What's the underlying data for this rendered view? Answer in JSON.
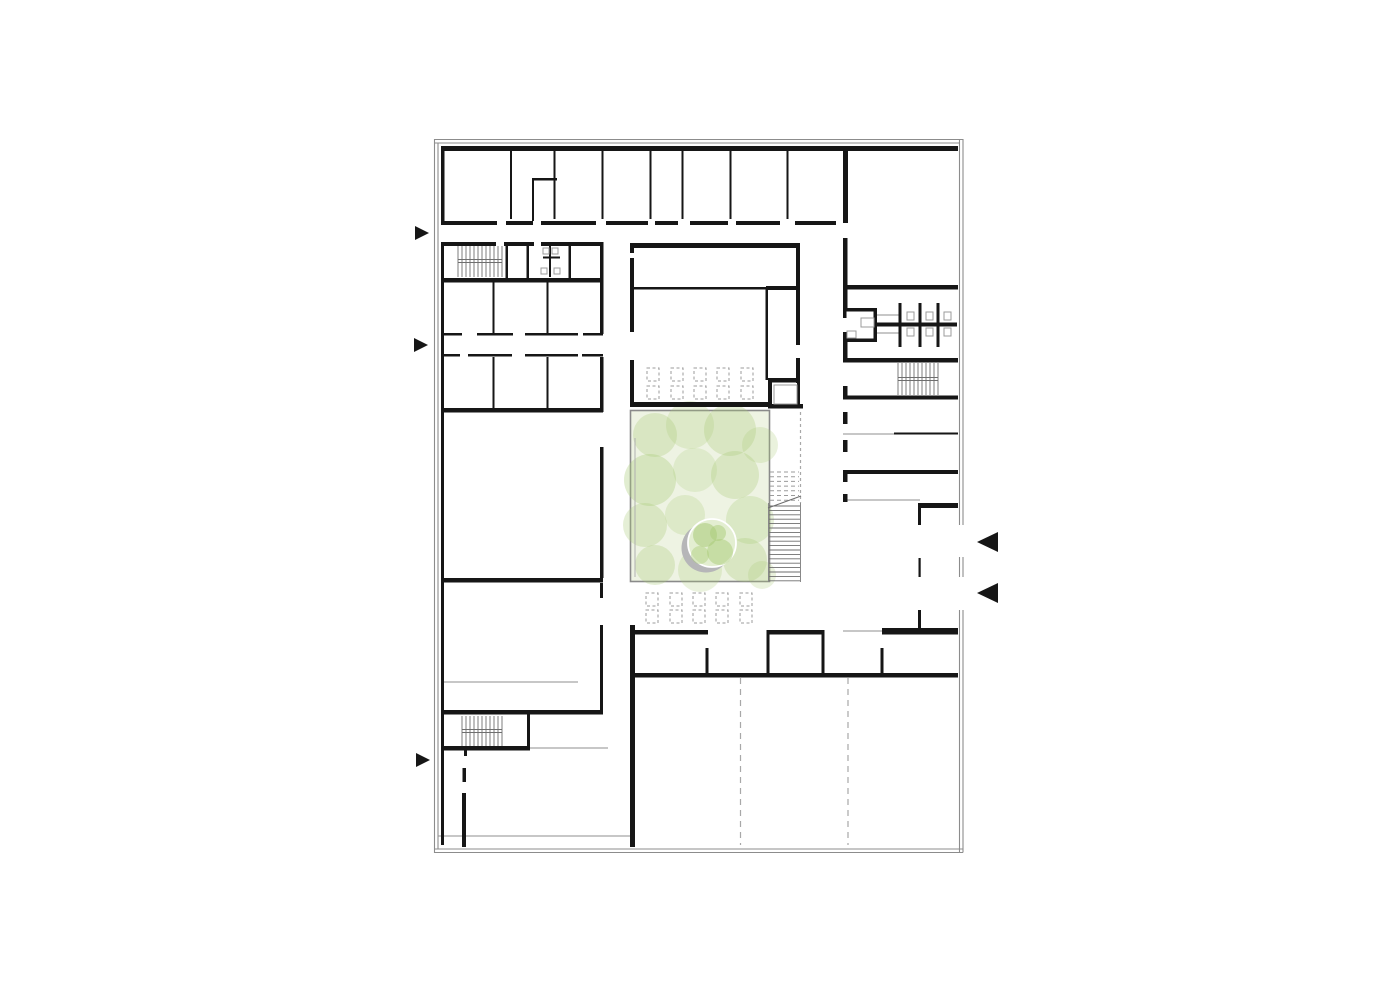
{
  "meta": {
    "description": "architectural-floor-plan",
    "canvas": {
      "w": 1400,
      "h": 990
    }
  },
  "colors": {
    "background": "#ffffff",
    "wall": "#161616",
    "frame": "#8c8c8c",
    "thin_line": "#8f8f8f",
    "dash_line": "#a8a8a8",
    "tread": "#6e6e6e",
    "tread_light": "#9b9b9b",
    "fixture": "#9b9b9b",
    "courtyard_border": "#8a8a8a",
    "courtyard_base": "#eef3e3",
    "blob_green": "#aacb78",
    "tree_shadow": "#b6b6b8",
    "tree_fill": "#e3eed1",
    "tree_ring": "#ffffff",
    "table_stroke": "#9b9b9b"
  },
  "plan": {
    "frame_lines": [
      {
        "x1": 434,
        "y1": 139.5,
        "x2": 963,
        "y2": 139.5
      },
      {
        "x1": 434,
        "y1": 143,
        "x2": 959.5,
        "y2": 143
      },
      {
        "x1": 434.5,
        "y1": 139,
        "x2": 434.5,
        "y2": 853
      },
      {
        "x1": 438,
        "y1": 143,
        "x2": 438,
        "y2": 849
      },
      {
        "x1": 434,
        "y1": 849,
        "x2": 963,
        "y2": 849
      },
      {
        "x1": 434,
        "y1": 852.5,
        "x2": 963,
        "y2": 852.5
      },
      {
        "x1": 959.5,
        "y1": 139,
        "x2": 959.5,
        "y2": 525
      },
      {
        "x1": 963,
        "y1": 139,
        "x2": 963,
        "y2": 525
      },
      {
        "x1": 959.5,
        "y1": 557,
        "x2": 959.5,
        "y2": 577
      },
      {
        "x1": 963,
        "y1": 557,
        "x2": 963,
        "y2": 577
      },
      {
        "x1": 959.5,
        "y1": 610,
        "x2": 959.5,
        "y2": 852.5
      },
      {
        "x1": 963,
        "y1": 610,
        "x2": 963,
        "y2": 852.5
      }
    ],
    "courtyard": {
      "rect": {
        "x": 630.5,
        "y": 410.5,
        "w": 139,
        "h": 171
      },
      "inner_line": {
        "x1": 635,
        "y1": 438,
        "x2": 635,
        "y2": 577
      },
      "blobs": [
        {
          "cx": 655,
          "cy": 435,
          "r": 22,
          "o": 0.3
        },
        {
          "cx": 690,
          "cy": 425,
          "r": 24,
          "o": 0.25
        },
        {
          "cx": 730,
          "cy": 430,
          "r": 26,
          "o": 0.3
        },
        {
          "cx": 760,
          "cy": 445,
          "r": 18,
          "o": 0.25
        },
        {
          "cx": 650,
          "cy": 480,
          "r": 26,
          "o": 0.35
        },
        {
          "cx": 695,
          "cy": 470,
          "r": 22,
          "o": 0.22
        },
        {
          "cx": 735,
          "cy": 475,
          "r": 24,
          "o": 0.3
        },
        {
          "cx": 645,
          "cy": 525,
          "r": 22,
          "o": 0.3
        },
        {
          "cx": 685,
          "cy": 515,
          "r": 20,
          "o": 0.25
        },
        {
          "cx": 750,
          "cy": 520,
          "r": 24,
          "o": 0.28
        },
        {
          "cx": 655,
          "cy": 565,
          "r": 20,
          "o": 0.3
        },
        {
          "cx": 700,
          "cy": 570,
          "r": 22,
          "o": 0.25
        },
        {
          "cx": 745,
          "cy": 560,
          "r": 22,
          "o": 0.3
        },
        {
          "cx": 762,
          "cy": 575,
          "r": 14,
          "o": 0.25
        }
      ],
      "tree": {
        "shadow": {
          "cx": 706,
          "cy": 548,
          "r": 24.5
        },
        "canopy": {
          "cx": 712,
          "cy": 543,
          "r": 24
        },
        "blotches": [
          {
            "cx": 705,
            "cy": 535,
            "r": 12,
            "o": 0.55
          },
          {
            "cx": 720,
            "cy": 552,
            "r": 13,
            "o": 0.5
          },
          {
            "cx": 700,
            "cy": 555,
            "r": 9,
            "o": 0.45
          },
          {
            "cx": 718,
            "cy": 533,
            "r": 8,
            "o": 0.5
          }
        ]
      }
    },
    "walls": [
      [
        441,
        146,
        517,
        5
      ],
      [
        441,
        146,
        3.5,
        76
      ],
      [
        843,
        146,
        5,
        77
      ],
      [
        510,
        151,
        2,
        68
      ],
      [
        553.5,
        151,
        2,
        68
      ],
      [
        601.5,
        151,
        2,
        68
      ],
      [
        649.5,
        151,
        2,
        68
      ],
      [
        681.5,
        151,
        2,
        68
      ],
      [
        729.5,
        151,
        2,
        68
      ],
      [
        786.5,
        151,
        2,
        68
      ],
      [
        532,
        180,
        2,
        41
      ],
      [
        532,
        178,
        25,
        2.5
      ],
      [
        441,
        221,
        56,
        4
      ],
      [
        506,
        221,
        27,
        4
      ],
      [
        541,
        221,
        55,
        4
      ],
      [
        606,
        221,
        42,
        4
      ],
      [
        655,
        221,
        23,
        4
      ],
      [
        690,
        221,
        38,
        4
      ],
      [
        736,
        221,
        44,
        4
      ],
      [
        795,
        221,
        41,
        4
      ],
      [
        441,
        242,
        3,
        603
      ],
      [
        444,
        242,
        52,
        4
      ],
      [
        504,
        242,
        30,
        4
      ],
      [
        541,
        242,
        62,
        4
      ],
      [
        505.5,
        242,
        2.5,
        40
      ],
      [
        526.5,
        242,
        2.5,
        40
      ],
      [
        549,
        246,
        2,
        31
      ],
      [
        568.5,
        242,
        2.5,
        40
      ],
      [
        543,
        256.5,
        17,
        2
      ],
      [
        441,
        278,
        162,
        4.5
      ],
      [
        492.5,
        282,
        2,
        52
      ],
      [
        546.5,
        282,
        2,
        52
      ],
      [
        600,
        242,
        3.5,
        92
      ],
      [
        442,
        333,
        20,
        2.5
      ],
      [
        477,
        333,
        36,
        2.5
      ],
      [
        525,
        333,
        53,
        2.5
      ],
      [
        583,
        333,
        20,
        2.5
      ],
      [
        442,
        354,
        18,
        2.5
      ],
      [
        468,
        354,
        44,
        2.5
      ],
      [
        525,
        354,
        53,
        2.5
      ],
      [
        582,
        354,
        21,
        2.5
      ],
      [
        492.5,
        357,
        2,
        53
      ],
      [
        546.5,
        357,
        2,
        53
      ],
      [
        600,
        357,
        3.5,
        55
      ],
      [
        441,
        408,
        162,
        4.5
      ],
      [
        600,
        447,
        3.5,
        131
      ],
      [
        441,
        578,
        162,
        4.5
      ],
      [
        600,
        583,
        3,
        15
      ],
      [
        600,
        625,
        3,
        87
      ],
      [
        441,
        710,
        162,
        4.5
      ],
      [
        527,
        714,
        3,
        35
      ],
      [
        441,
        746,
        89,
        4.5
      ],
      [
        464,
        750,
        3,
        6
      ],
      [
        462.5,
        768,
        3.5,
        14
      ],
      [
        462,
        793,
        4,
        54
      ],
      [
        630,
        243,
        170,
        5
      ],
      [
        630,
        243,
        4,
        10
      ],
      [
        630,
        258,
        4,
        74
      ],
      [
        630,
        360,
        4,
        47
      ],
      [
        796,
        243,
        4,
        102
      ],
      [
        796,
        358,
        4,
        25
      ],
      [
        630,
        287,
        138,
        2.5
      ],
      [
        766,
        286,
        34,
        4
      ],
      [
        765.5,
        288,
        2.5,
        92
      ],
      [
        768,
        378,
        32,
        4.5
      ],
      [
        768,
        380,
        4,
        28
      ],
      [
        797,
        383,
        3,
        25
      ],
      [
        768,
        404,
        35,
        4.5
      ],
      [
        630,
        402,
        138,
        5
      ],
      [
        630,
        625,
        5,
        222
      ],
      [
        632,
        630,
        76,
        4.5
      ],
      [
        768,
        630,
        55,
        4.5
      ],
      [
        882,
        630,
        76,
        4.5
      ],
      [
        705.5,
        648,
        3,
        29
      ],
      [
        766.5,
        630,
        3,
        47
      ],
      [
        821.5,
        630,
        3,
        47
      ],
      [
        880.5,
        648,
        3,
        29
      ],
      [
        630,
        673,
        328,
        4.5
      ],
      [
        843,
        238,
        4.5,
        70
      ],
      [
        843,
        342,
        4.5,
        20
      ],
      [
        843,
        386,
        4.5,
        13
      ],
      [
        843,
        412,
        4.5,
        12
      ],
      [
        843,
        440,
        4.5,
        12
      ],
      [
        843,
        470,
        4.5,
        12
      ],
      [
        843,
        494,
        4.5,
        8
      ],
      [
        843,
        285,
        115,
        4.5
      ],
      [
        843,
        308,
        34,
        3.5
      ],
      [
        843,
        338.5,
        34,
        3.5
      ],
      [
        873.5,
        308,
        3.5,
        34
      ],
      [
        843,
        308,
        3.5,
        10
      ],
      [
        843,
        332,
        3.5,
        10
      ],
      [
        877,
        322.5,
        80,
        4
      ],
      [
        898.5,
        303,
        3,
        44
      ],
      [
        918.5,
        303,
        3,
        44
      ],
      [
        936.5,
        303,
        3,
        44
      ],
      [
        843,
        358,
        115,
        4.5
      ],
      [
        843,
        395.5,
        115,
        4
      ],
      [
        894,
        432.5,
        64,
        2
      ],
      [
        843,
        470,
        115,
        4
      ],
      [
        918,
        503,
        40,
        5
      ],
      [
        918,
        508,
        3,
        17
      ],
      [
        918.5,
        558,
        2.2,
        19
      ],
      [
        918,
        610,
        3,
        20
      ],
      [
        882,
        628,
        76,
        6
      ]
    ],
    "thin_lines": [
      {
        "x1": 443,
        "y1": 682,
        "x2": 578,
        "y2": 682
      },
      {
        "x1": 530,
        "y1": 748,
        "x2": 608,
        "y2": 748
      },
      {
        "x1": 843,
        "y1": 631,
        "x2": 882,
        "y2": 631
      },
      {
        "x1": 843,
        "y1": 434,
        "x2": 895,
        "y2": 434
      },
      {
        "x1": 843,
        "y1": 500,
        "x2": 920,
        "y2": 500
      },
      {
        "x1": 877,
        "y1": 315,
        "x2": 899,
        "y2": 315
      },
      {
        "x1": 877,
        "y1": 333,
        "x2": 899,
        "y2": 333
      },
      {
        "x1": 438,
        "y1": 836,
        "x2": 630,
        "y2": 836
      }
    ],
    "dashed_lines": [
      {
        "x1": 740.5,
        "y1": 678,
        "x2": 740.5,
        "y2": 845,
        "dash": "6,5"
      },
      {
        "x1": 848,
        "y1": 678,
        "x2": 848,
        "y2": 845,
        "dash": "6,5"
      },
      {
        "x1": 800.5,
        "y1": 412,
        "x2": 800.5,
        "y2": 503,
        "dash": "3,3"
      }
    ],
    "stairs": [
      {
        "id": "stair-northwest",
        "x": 458,
        "y": 246,
        "w": 44,
        "h": 31,
        "step": 4,
        "landings": [
          259.5,
          262.5
        ]
      },
      {
        "id": "stair-southwest",
        "x": 462,
        "y": 716,
        "w": 40,
        "h": 30,
        "step": 4,
        "landings": [
          729.5,
          732.5
        ]
      },
      {
        "id": "stair-east",
        "x": 898,
        "y": 363,
        "w": 40,
        "h": 32,
        "step": 4,
        "landings": [
          377.5,
          380.5
        ]
      }
    ],
    "courtyard_stair": {
      "x": 768.5,
      "w": 32,
      "solid_y1": 506,
      "solid_y2": 582,
      "solid_step": 4.4,
      "dashed_y1": 472,
      "dashed_y2": 500.5,
      "dashed_step": 4.7,
      "rails": [
        {
          "x1": 768.5,
          "y1": 503,
          "x2": 768.5,
          "y2": 582
        },
        {
          "x1": 800.5,
          "y1": 503,
          "x2": 800.5,
          "y2": 582
        }
      ],
      "break_line": {
        "x1": 768,
        "y1": 508,
        "x2": 801,
        "y2": 496
      }
    },
    "tables": [
      {
        "id": "hall-tables",
        "cols_x": [
          647,
          671,
          694,
          717,
          741
        ],
        "rows_y": [
          368,
          386
        ],
        "w": 12,
        "h": 13
      },
      {
        "id": "plaza-tables",
        "cols_x": [
          646,
          670,
          693,
          716,
          740
        ],
        "rows_y": [
          593,
          610
        ],
        "w": 12,
        "h": 13
      }
    ],
    "fixtures": [
      [
        543,
        248,
        6,
        6
      ],
      [
        552,
        248,
        6,
        6
      ],
      [
        541,
        268,
        6,
        6
      ],
      [
        554,
        268,
        6,
        6
      ],
      [
        861,
        318,
        13,
        9
      ],
      [
        847,
        331,
        9,
        7
      ],
      [
        907,
        312,
        7,
        8
      ],
      [
        907,
        328,
        7,
        8
      ],
      [
        926,
        312,
        7,
        8
      ],
      [
        926,
        328,
        7,
        8
      ],
      [
        944,
        312,
        7,
        8
      ],
      [
        944,
        328,
        7,
        8
      ],
      [
        774,
        385,
        23,
        19
      ]
    ],
    "entry_arrows": [
      {
        "id": "entry-arrow-west-1",
        "points": "415,226 415,240 429,233"
      },
      {
        "id": "entry-arrow-west-2",
        "points": "414,338 414,352 428,345"
      },
      {
        "id": "entry-arrow-west-3",
        "points": "416,753 416,767 430,760"
      },
      {
        "id": "entry-arrow-east-1",
        "points": "998,532 998,552 977,542"
      },
      {
        "id": "entry-arrow-east-2",
        "points": "998,583 998,603 977,593"
      }
    ]
  }
}
